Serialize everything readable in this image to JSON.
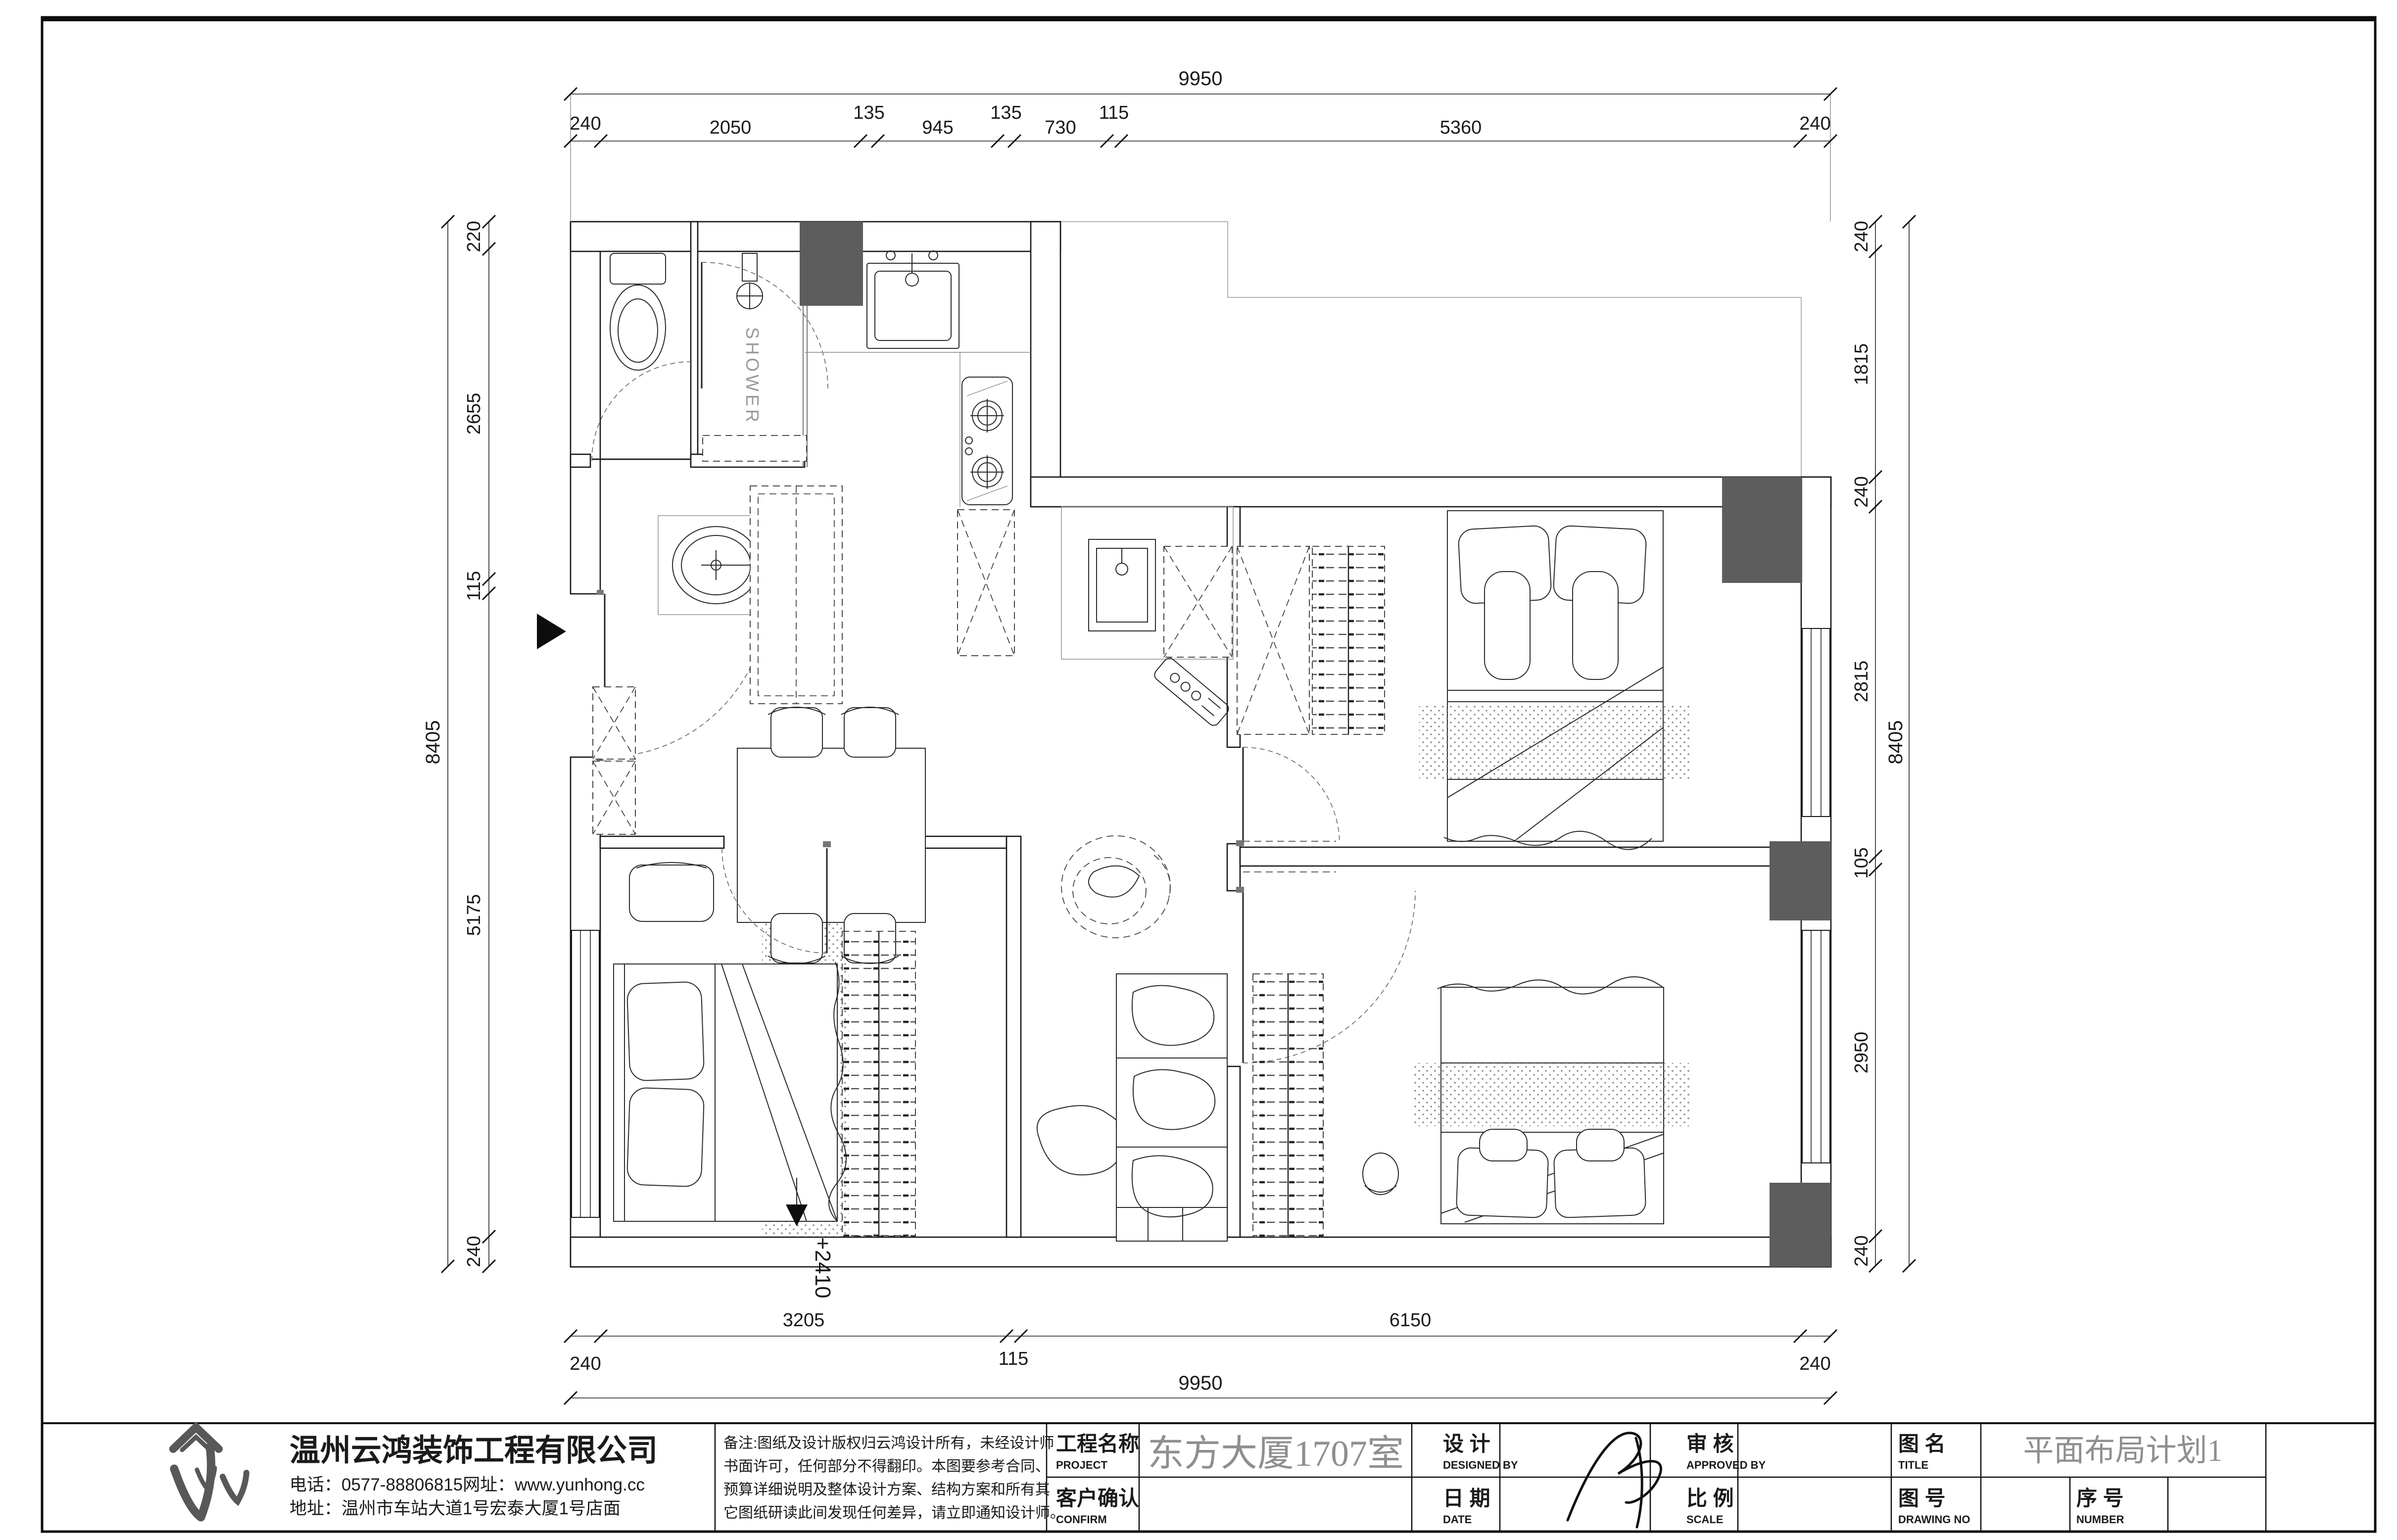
{
  "sheet": {
    "dims": {
      "top": {
        "overall": "9950",
        "segments": [
          "240",
          "2050",
          "135",
          "945",
          "135",
          "730",
          "115",
          "5360",
          "240"
        ]
      },
      "bottom": {
        "overall": "9950",
        "upper": [
          "3205",
          "6150"
        ],
        "lower": [
          "240",
          "115",
          "240"
        ]
      },
      "left": {
        "overall": "8405",
        "segments": [
          "220",
          "2655",
          "115",
          "5175",
          "240"
        ]
      },
      "right": {
        "overall": "8405",
        "segments": [
          "240",
          "1815",
          "240",
          "2815",
          "105",
          "2950",
          "240"
        ]
      }
    },
    "plan_labels": {
      "shower": "SHOWER",
      "floor_level": "+2410"
    },
    "title_block": {
      "company": {
        "name": "温州云鸿装饰工程有限公司",
        "phone": "电话：0577-88806815网址：www.yunhong.cc",
        "address": "地址：温州市车站大道1号宏泰大厦1号店面"
      },
      "notes": [
        "备注:图纸及设计版权归云鸿设计所有，未经设计师",
        "书面许可，任何部分不得翻印。本图要参考合同、",
        "预算详细说明及整体设计方案、结构方案和所有其",
        "它图纸研读此间发现任何差异，请立即通知设计师。"
      ],
      "project": {
        "label": "工程名称",
        "label_en": "PROJECT",
        "value": "东方大厦1707室"
      },
      "confirm": {
        "label": "客户确认",
        "label_en": "CONFIRM",
        "value": ""
      },
      "designed": {
        "label": "设 计",
        "label_en": "DESIGNED BY"
      },
      "date": {
        "label": "日 期",
        "label_en": "DATE",
        "value": ""
      },
      "approved": {
        "label": "审 核",
        "label_en": "APPROVED BY",
        "value": ""
      },
      "scale": {
        "label": "比 例",
        "label_en": "SCALE",
        "value": ""
      },
      "title": {
        "label": "图 名",
        "label_en": "TITLE",
        "value": "平面布局计划1"
      },
      "drawing_no": {
        "label": "图 号",
        "label_en": "DRAWING NO",
        "value": ""
      },
      "number": {
        "label": "序 号",
        "label_en": "NUMBER",
        "value": ""
      }
    },
    "colors": {
      "line": "#1a1a1a",
      "gray_text": "#8f8f8f",
      "column_fill": "#5d5d5d"
    }
  }
}
